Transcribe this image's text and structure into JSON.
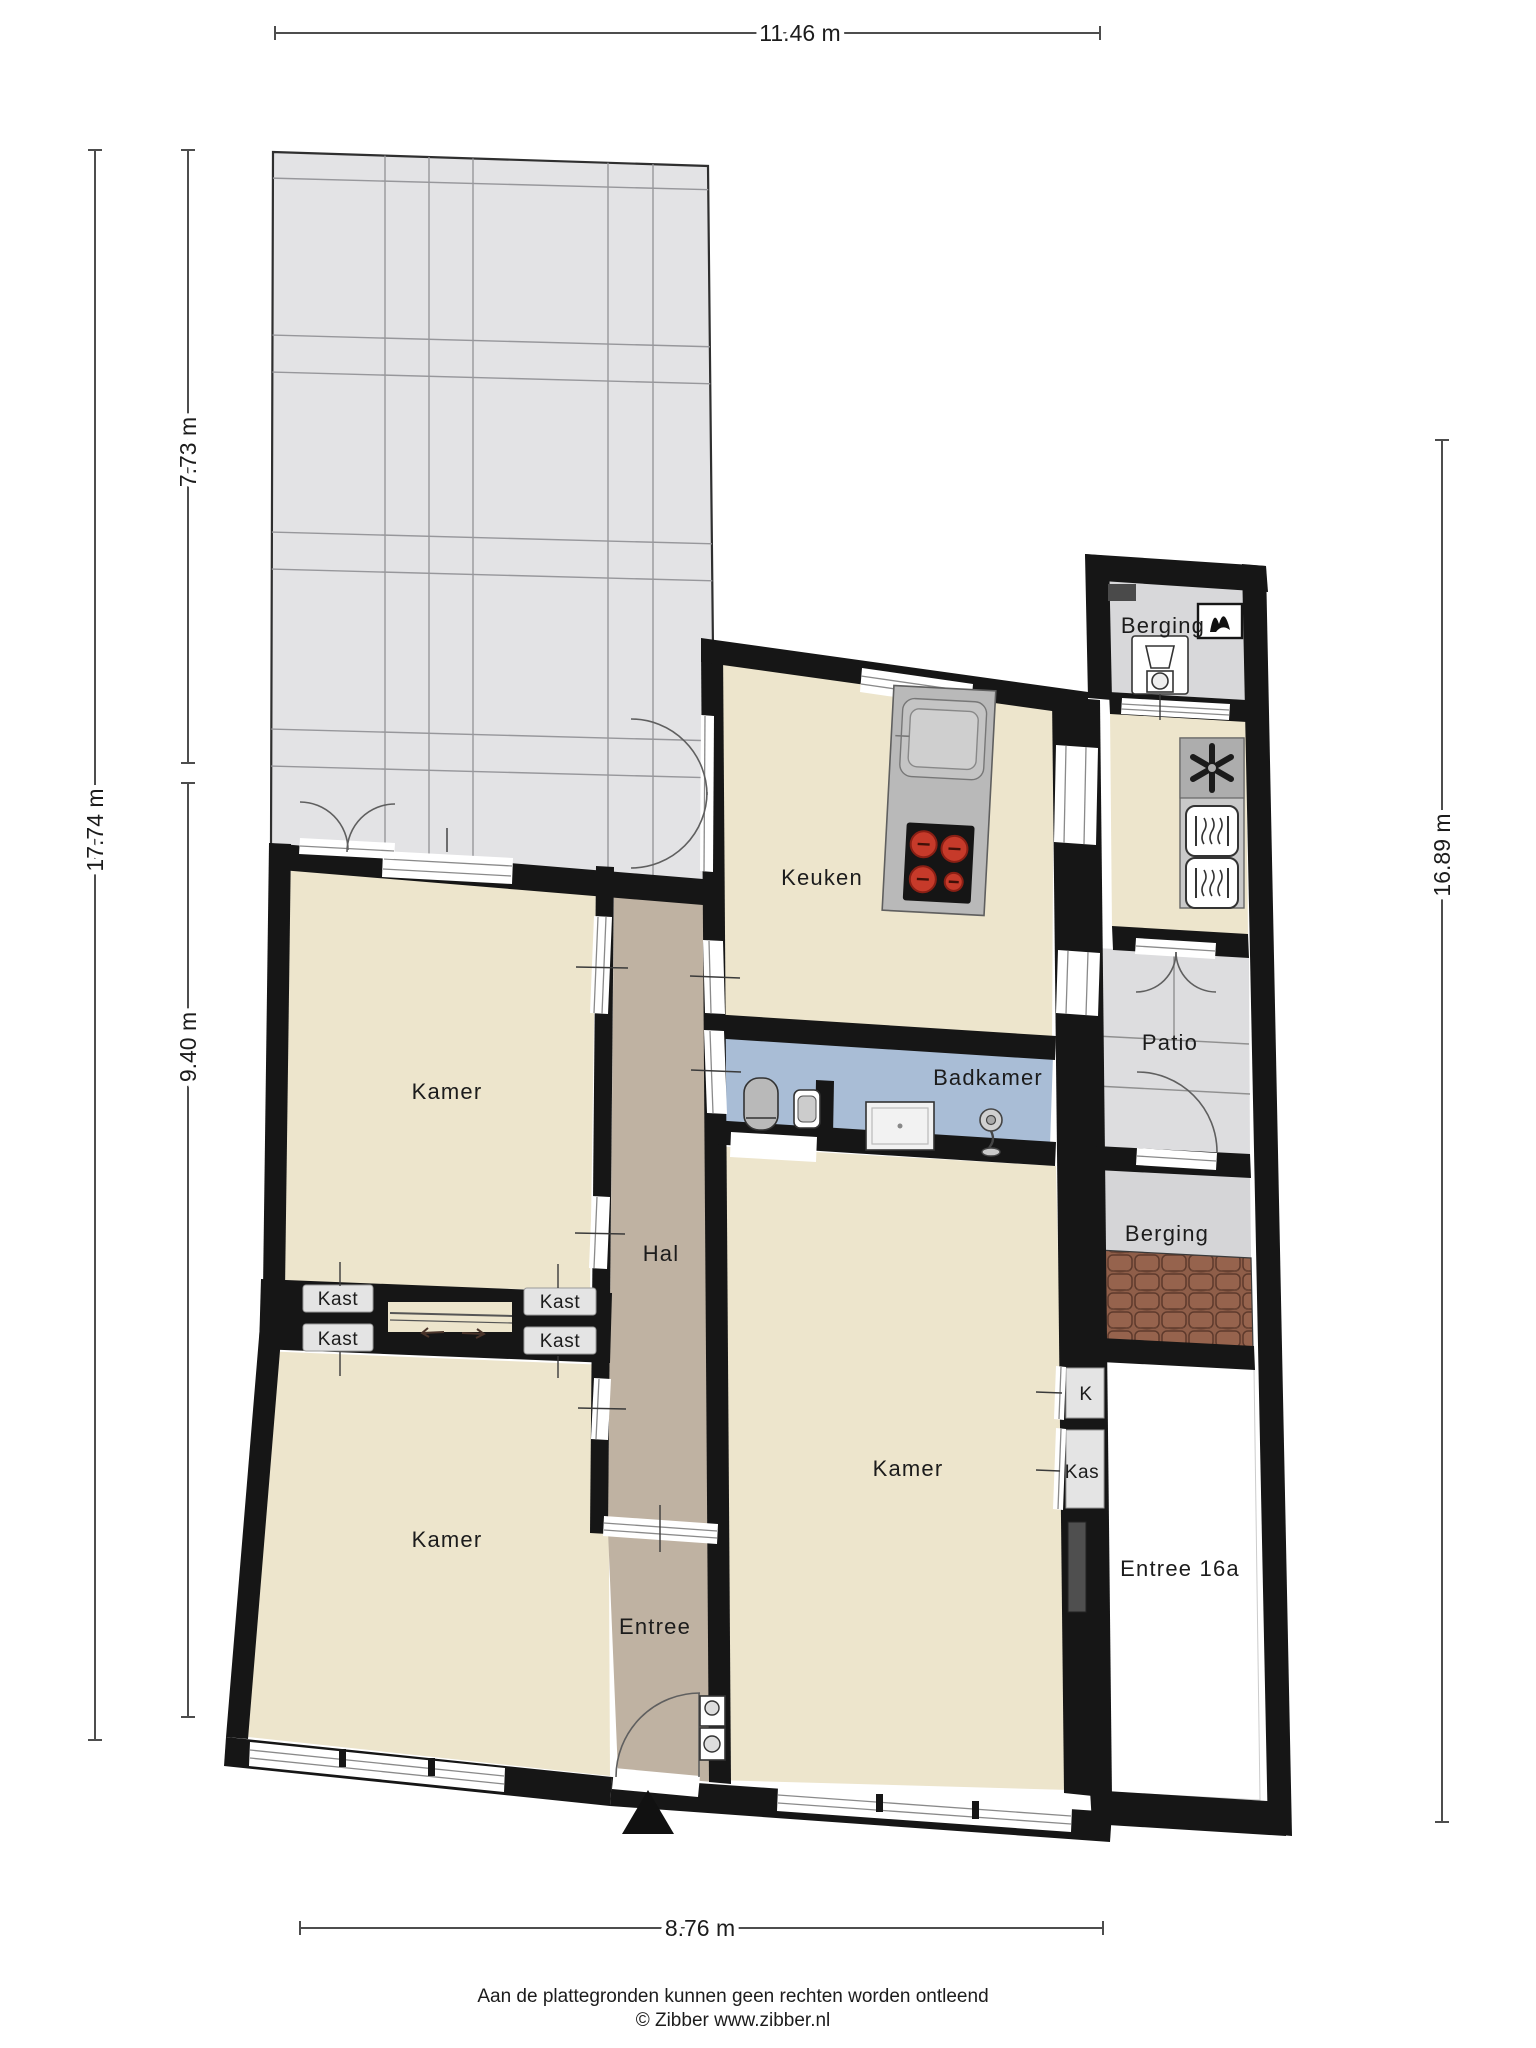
{
  "title": "Floor plan",
  "dimensions": {
    "top": "11.46 m",
    "left_total": "17.74 m",
    "left_upper": "7.73 m",
    "left_lower": "9.40 m",
    "right": "16.89 m",
    "bottom": "8.76 m"
  },
  "rooms": {
    "berging_top": "Berging",
    "keuken": "Keuken",
    "patio": "Patio",
    "badkamer": "Badkamer",
    "berging_mid": "Berging",
    "kamer_top_left": "Kamer",
    "hal": "Hal",
    "kast_top_left": "Kast",
    "kast_bottom_left": "Kast",
    "kast_top_right": "Kast",
    "kast_bottom_right": "Kast",
    "kamer_bottom_left": "Kamer",
    "kamer_right": "Kamer",
    "closet_k": "K",
    "closet_kas": "Kas",
    "entree": "Entree",
    "entree_16a": "Entree 16a"
  },
  "icons": {
    "washing_machine": "washing-machine",
    "boiler": "boiler-vent",
    "extractor_fan": "extractor-fan",
    "oven_upper": "oven",
    "oven_lower": "oven",
    "cooktop": "cooktop-4-burners",
    "island_sink": "kitchen-island-sink",
    "toilet": "toilet",
    "washbasin": "washbasin",
    "shower": "shower-tray",
    "shower_fixture": "shower-fixture",
    "meter_boxes": "meter-boxes",
    "entrance_marker": "entrance-triangle"
  },
  "footer": {
    "disclaimer": "Aan de plattegronden kunnen geen rechten worden ontleend",
    "credit": "© Zibber www.zibber.nl"
  },
  "colors": {
    "wall": "#161616",
    "floor_cream": "#EDE5CC",
    "floor_taupe": "#BFB2A2",
    "floor_blue": "#A9BDD6",
    "terrace_gray": "#E3E3E5",
    "room_gray": "#D8D8DA",
    "patio_gray": "#DDDDDF",
    "roof_tiles": "#8F5E49",
    "burner_red": "#C63A2A"
  }
}
